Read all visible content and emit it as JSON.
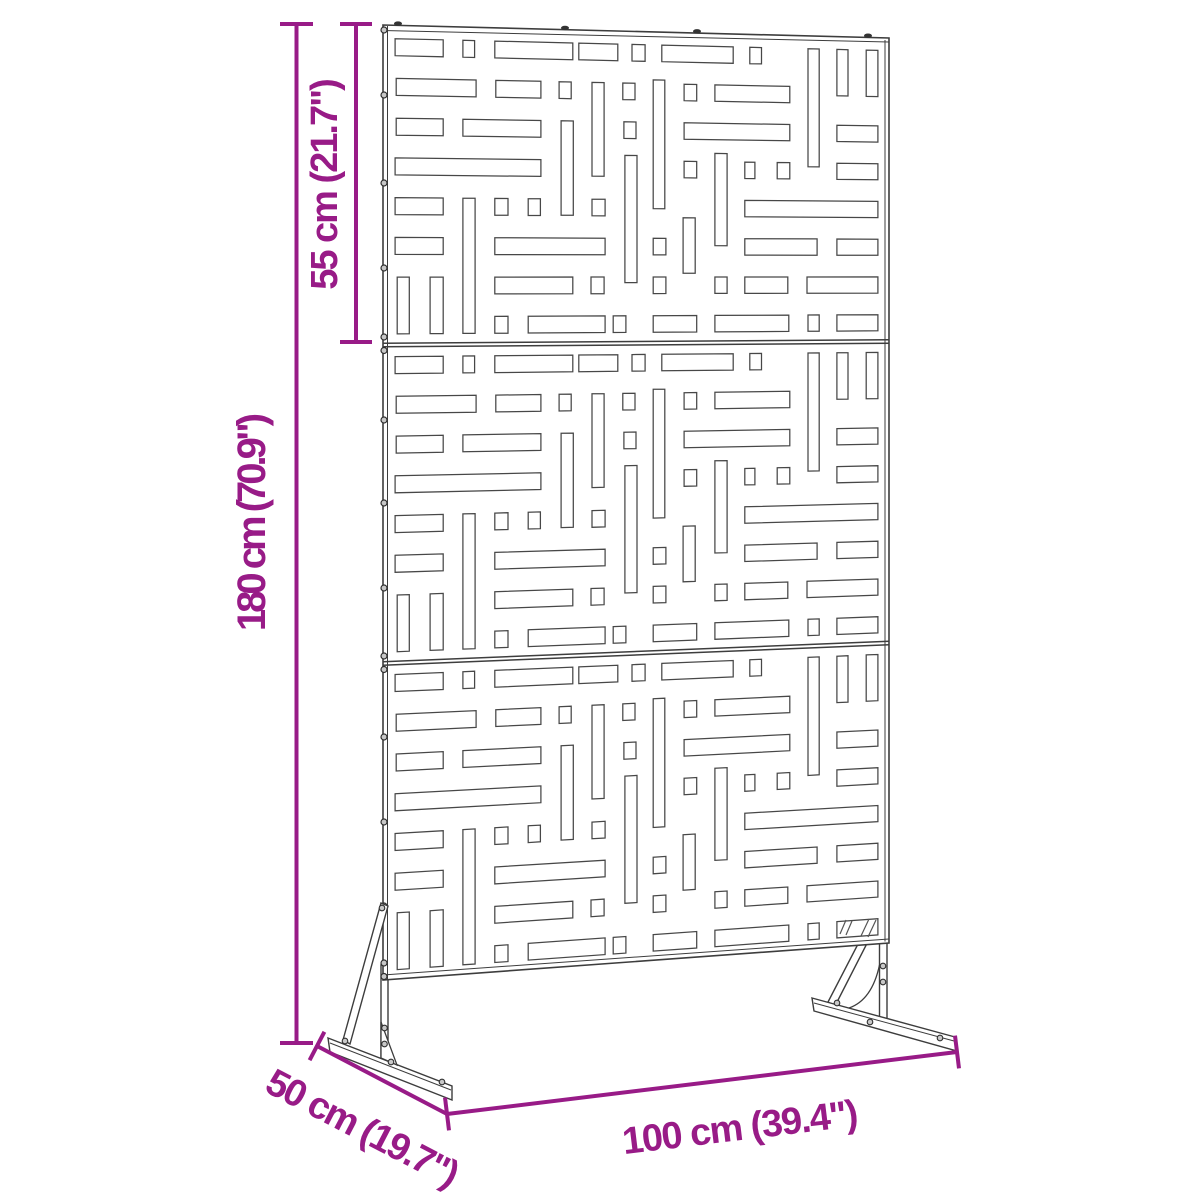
{
  "diagram": {
    "dimension_labels": {
      "panel_section_height": "55 cm (21.7\")",
      "total_height": "180 cm (70.9\")",
      "depth": "50 cm (19.7\")",
      "width": "100 cm (39.4\")"
    },
    "colors": {
      "dimension_accent": "#981B87",
      "drawing_line": "#3D3D3D",
      "background": "#FFFFFF"
    },
    "screen": {
      "panel_sections": 3,
      "pattern_rows_per_section": 8,
      "corners": {
        "tl": [
          383,
          25
        ],
        "tr": [
          889,
          38
        ],
        "br": [
          889,
          943
        ],
        "bl": [
          383,
          980
        ]
      },
      "left_edge_screws_y": [
        30,
        95,
        183,
        268,
        337,
        350.5,
        420,
        503,
        588,
        656,
        669.5,
        737,
        822,
        906,
        963,
        976.5
      ],
      "top_edge_screws_x": [
        398,
        565,
        697,
        868
      ],
      "pattern": [
        {
          "u": [
            0.024,
            0.119
          ],
          "r": 0
        },
        {
          "u": [
            0.158,
            0.181
          ],
          "r": 0
        },
        {
          "u": [
            0.221,
            0.375
          ],
          "r": 0
        },
        {
          "u": [
            0.387,
            0.464
          ],
          "r": 0
        },
        {
          "u": [
            0.492,
            0.518
          ],
          "r": 0
        },
        {
          "u": [
            0.551,
            0.692
          ],
          "r": 0
        },
        {
          "u": [
            0.725,
            0.748
          ],
          "r": 0
        },
        {
          "u": [
            0.84,
            0.862
          ],
          "v": [
            0.042,
            0.43
          ]
        },
        {
          "u": [
            0.897,
            0.919
          ],
          "v": [
            0.042,
            0.195
          ]
        },
        {
          "u": [
            0.955,
            0.978
          ],
          "v": [
            0.042,
            0.195
          ]
        },
        {
          "u": [
            0.026,
            0.184
          ],
          "r": 1
        },
        {
          "u": [
            0.223,
            0.312
          ],
          "r": 1
        },
        {
          "u": [
            0.348,
            0.372
          ],
          "r": 1
        },
        {
          "u": [
            0.413,
            0.437
          ],
          "v": [
            0.167,
            0.468
          ]
        },
        {
          "u": [
            0.474,
            0.498
          ],
          "r": 1
        },
        {
          "u": [
            0.534,
            0.557
          ],
          "v": [
            0.155,
            0.571
          ]
        },
        {
          "u": [
            0.595,
            0.62
          ],
          "r": 1
        },
        {
          "u": [
            0.656,
            0.804
          ],
          "r": 1
        },
        {
          "u": [
            0.026,
            0.119
          ],
          "r": 2
        },
        {
          "u": [
            0.158,
            0.312
          ],
          "r": 2
        },
        {
          "u": [
            0.352,
            0.376
          ],
          "v": [
            0.292,
            0.594
          ]
        },
        {
          "u": [
            0.476,
            0.5
          ],
          "r": 2
        },
        {
          "u": [
            0.595,
            0.804
          ],
          "r": 2
        },
        {
          "u": [
            0.897,
            0.978
          ],
          "r": 2
        },
        {
          "u": [
            0.024,
            0.312
          ],
          "r": 3
        },
        {
          "u": [
            0.595,
            0.62
          ],
          "r": 3
        },
        {
          "u": [
            0.656,
            0.68
          ],
          "v": [
            0.39,
            0.69
          ]
        },
        {
          "u": [
            0.715,
            0.735
          ],
          "r": 3
        },
        {
          "u": [
            0.779,
            0.804
          ],
          "r": 3
        },
        {
          "u": [
            0.897,
            0.978
          ],
          "r": 3
        },
        {
          "u": [
            0.478,
            0.502
          ],
          "v": [
            0.4,
            0.81
          ]
        },
        {
          "u": [
            0.024,
            0.119
          ],
          "r": 4
        },
        {
          "u": [
            0.221,
            0.247
          ],
          "r": 4
        },
        {
          "u": [
            0.287,
            0.311
          ],
          "r": 4
        },
        {
          "u": [
            0.413,
            0.439
          ],
          "r": 4
        },
        {
          "u": [
            0.715,
            0.978
          ],
          "r": 4
        },
        {
          "u": [
            0.024,
            0.119
          ],
          "r": 5
        },
        {
          "u": [
            0.221,
            0.439
          ],
          "r": 5
        },
        {
          "u": [
            0.534,
            0.559
          ],
          "r": 5
        },
        {
          "u": [
            0.593,
            0.617
          ],
          "v": [
            0.6,
            0.78
          ]
        },
        {
          "u": [
            0.715,
            0.858
          ],
          "r": 5
        },
        {
          "u": [
            0.897,
            0.978
          ],
          "r": 5
        },
        {
          "u": [
            0.028,
            0.052
          ],
          "v": [
            0.792,
            0.9705
          ]
        },
        {
          "u": [
            0.093,
            0.119
          ],
          "v": [
            0.792,
            0.9705
          ]
        },
        {
          "u": [
            0.158,
            0.182
          ],
          "v": [
            0.542,
            0.9705
          ]
        },
        {
          "u": [
            0.221,
            0.375
          ],
          "r": 6
        },
        {
          "u": [
            0.411,
            0.437
          ],
          "r": 6
        },
        {
          "u": [
            0.534,
            0.559
          ],
          "r": 6
        },
        {
          "u": [
            0.656,
            0.68
          ],
          "r": 6
        },
        {
          "u": [
            0.715,
            0.8
          ],
          "r": 6
        },
        {
          "u": [
            0.838,
            0.978
          ],
          "r": 6
        },
        {
          "u": [
            0.221,
            0.247
          ],
          "r": 7
        },
        {
          "u": [
            0.287,
            0.439
          ],
          "r": 7
        },
        {
          "u": [
            0.455,
            0.48
          ],
          "r": 7
        },
        {
          "u": [
            0.534,
            0.62
          ],
          "r": 7
        },
        {
          "u": [
            0.656,
            0.802
          ],
          "r": 7
        },
        {
          "u": [
            0.84,
            0.862
          ],
          "r": 7
        },
        {
          "u": [
            0.897,
            0.978
          ],
          "r": 7
        }
      ]
    }
  }
}
